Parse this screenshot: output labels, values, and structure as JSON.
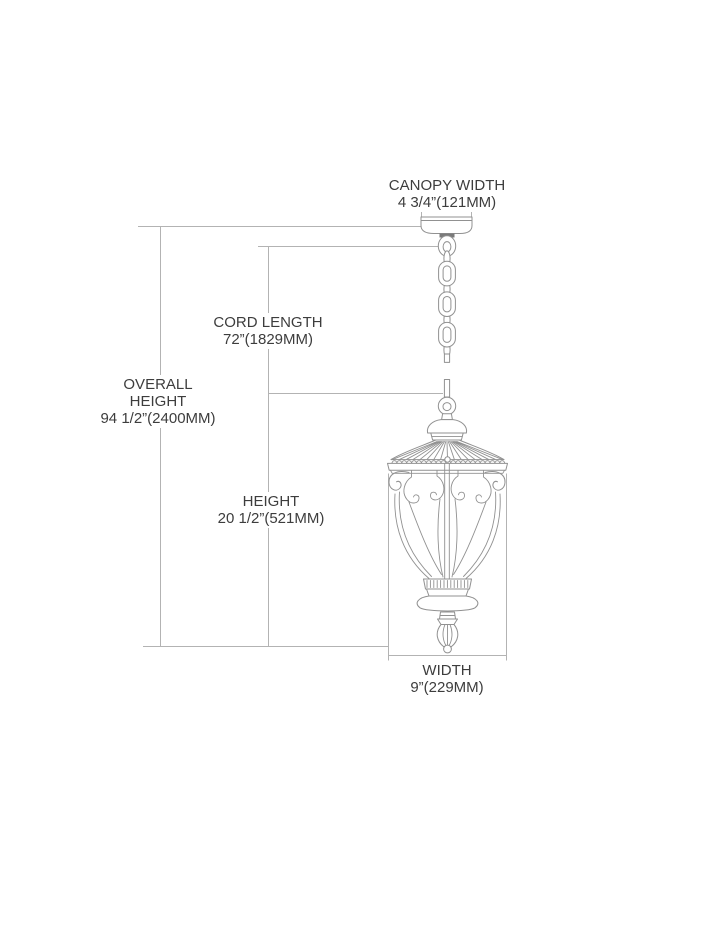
{
  "drawing": {
    "subject": "outdoor hanging lantern pendant with chain and ceiling canopy",
    "style": "technical dimension line drawing"
  },
  "labels": {
    "canopy_width": {
      "lines": [
        "CANOPY WIDTH",
        "4 3/4”(121MM)"
      ]
    },
    "cord_length": {
      "lines": [
        "CORD LENGTH",
        "72”(1829MM)"
      ]
    },
    "overall_height": {
      "lines": [
        "OVERALL",
        "HEIGHT",
        "94 1/2”(2400MM)"
      ]
    },
    "height": {
      "lines": [
        "HEIGHT",
        "20 1/2”(521MM)"
      ]
    },
    "width": {
      "lines": [
        "WIDTH",
        "9”(229MM)"
      ]
    }
  },
  "dimensions": {
    "canopy_width": {
      "inches": "4 3/4",
      "mm": 121
    },
    "cord_length": {
      "inches": "72",
      "mm": 1829
    },
    "overall_height": {
      "inches": "94 1/2",
      "mm": 2400
    },
    "height": {
      "inches": "20 1/2",
      "mm": 521
    },
    "width": {
      "inches": "9",
      "mm": 229
    }
  },
  "colors": {
    "background": "#ffffff",
    "dimension_line": "#b3b3b3",
    "drawing_line": "#919191",
    "drawing_dark": "#7a7a7a",
    "text": "#3d3d3d"
  }
}
